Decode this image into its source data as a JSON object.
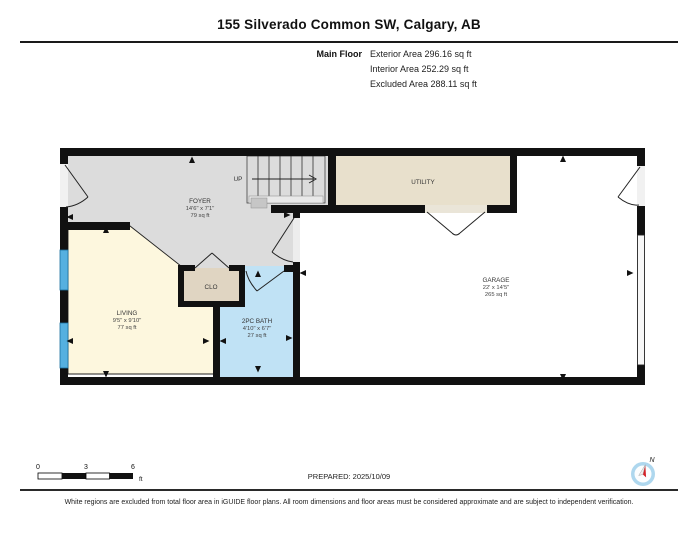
{
  "header": {
    "title": "155 Silverado Common SW, Calgary, AB",
    "floor_label": "Main Floor",
    "exterior_area": "Exterior Area 296.16 sq ft",
    "interior_area": "Interior Area 252.29 sq ft",
    "excluded_area": "Excluded Area 288.11 sq ft"
  },
  "plan": {
    "stairs_label": "UP",
    "rooms": {
      "foyer": {
        "name": "FOYER",
        "dims": "14'6\" x 7'1\"",
        "area": "79 sq ft"
      },
      "utility": {
        "name": "UTILITY"
      },
      "closet": {
        "name": "CLO"
      },
      "living": {
        "name": "LIVING",
        "dims": "9'5\" x 9'10\"",
        "area": "77 sq ft"
      },
      "bath": {
        "name": "2PC BATH",
        "dims": "4'10\" x 6'7\"",
        "area": "27 sq ft"
      },
      "garage": {
        "name": "GARAGE",
        "dims": "22' x 14'5\"",
        "area": "265 sq ft"
      }
    },
    "colors": {
      "wall": "#111111",
      "foyer": "#dcdcdc",
      "utility": "#e8e0cc",
      "closet": "#e0d5c2",
      "living": "#fdf7de",
      "bath": "#c0e2f5",
      "window": "#55b0e0",
      "threshold": "#ededed",
      "compass_ring": "#aed7ee",
      "needle_red": "#d42127"
    }
  },
  "scale_bar": {
    "tick0": "0",
    "tick1": "3",
    "tick2": "6",
    "unit": "ft"
  },
  "compass": {
    "label": "N"
  },
  "footer": {
    "prepared": "PREPARED: 2025/10/09",
    "disclaimer": "White regions are excluded from total floor area in iGUIDE floor plans. All room dimensions and floor areas must be considered approximate and are subject to independent verification."
  }
}
